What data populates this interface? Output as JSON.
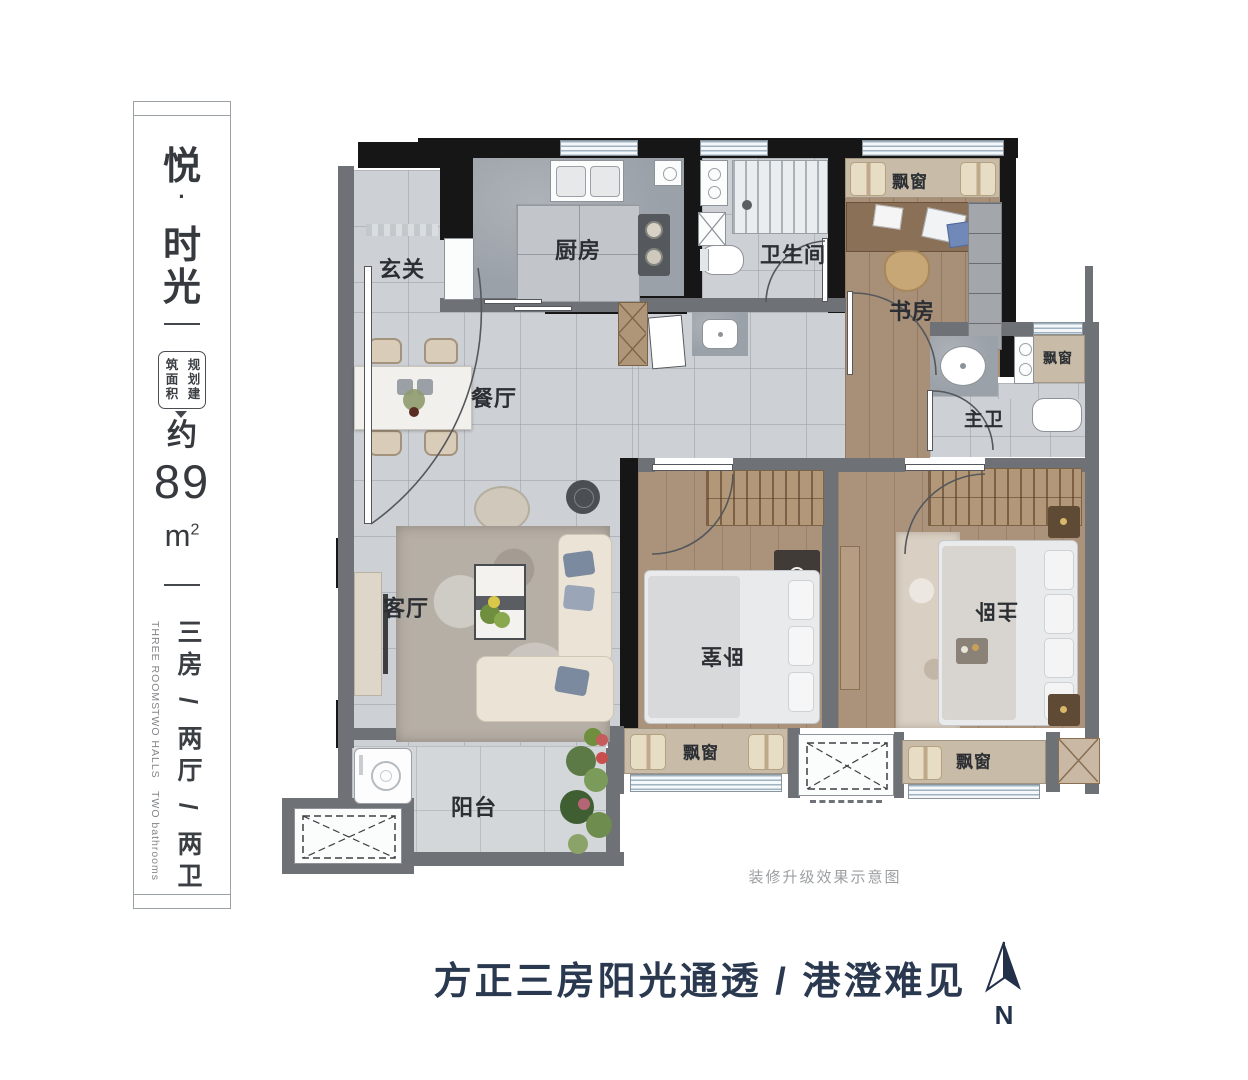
{
  "sidebar": {
    "title_chars": [
      "悦",
      "·",
      "时",
      "光"
    ],
    "area_label_left": "筑面积",
    "area_label_right": "规划建",
    "approx_label": "约",
    "area_value": "89",
    "area_unit": "m",
    "area_unit_sup": "2",
    "layout_vertical": "三房 / 两厅 / 两卫",
    "layout_en": [
      "THREE ROOMS",
      "TWO HALLS",
      "TWO bathrooms"
    ]
  },
  "plan": {
    "labels": [
      {
        "text": "玄关"
      },
      {
        "text": "厨房"
      },
      {
        "text": "卫生间"
      },
      {
        "text": "飘窗"
      },
      {
        "text": "书房"
      },
      {
        "text": "飘窗"
      },
      {
        "text": "主卫"
      },
      {
        "text": "餐厅"
      },
      {
        "text": "客厅"
      },
      {
        "text": "卧室"
      },
      {
        "text": "主卧"
      },
      {
        "text": "飘窗"
      },
      {
        "text": "飘窗"
      },
      {
        "text": "阳台"
      }
    ],
    "caption": "装修升级效果示意图"
  },
  "footer": {
    "headline": "方正三房阳光通透 / 港澄难见",
    "compass_label": "N"
  },
  "colors": {
    "headline": "#2a3950",
    "wall_black": "#161616",
    "wall_gray": "#6e7276",
    "bay_tan": "#c8bba8",
    "tile": "#cdd1d5",
    "wood": "#a88f77"
  }
}
